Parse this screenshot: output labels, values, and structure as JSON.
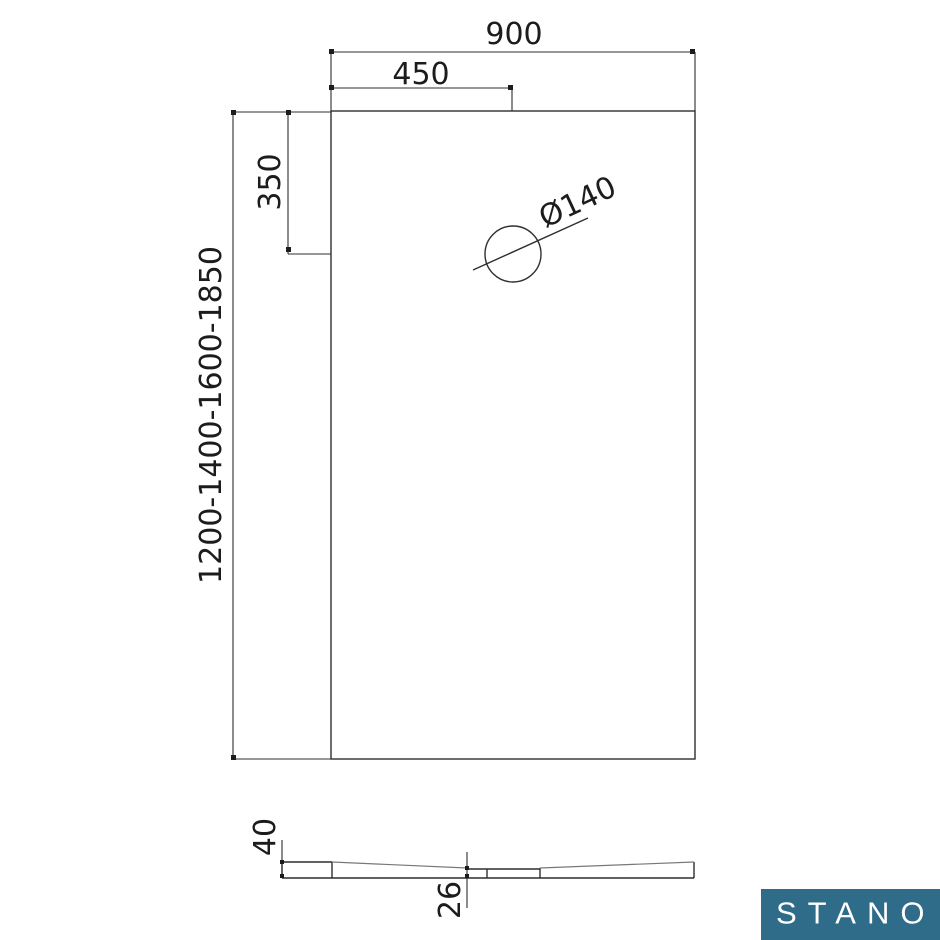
{
  "drawing": {
    "top_view": {
      "width_label": "900",
      "half_width_label": "450",
      "drain_offset_label": "350",
      "height_options_label": "1200-1400-1600-1850",
      "drain_diameter_label": "Ø140"
    },
    "section_view": {
      "edge_thickness_label": "40",
      "drain_thickness_label": "26"
    },
    "colors": {
      "line": "#2f2f2f",
      "slope_line": "#787878",
      "text": "#1c1c1c"
    }
  },
  "brand": {
    "name": "STANO",
    "bg_color": "#2e6c8a",
    "text_color": "#ffffff"
  }
}
